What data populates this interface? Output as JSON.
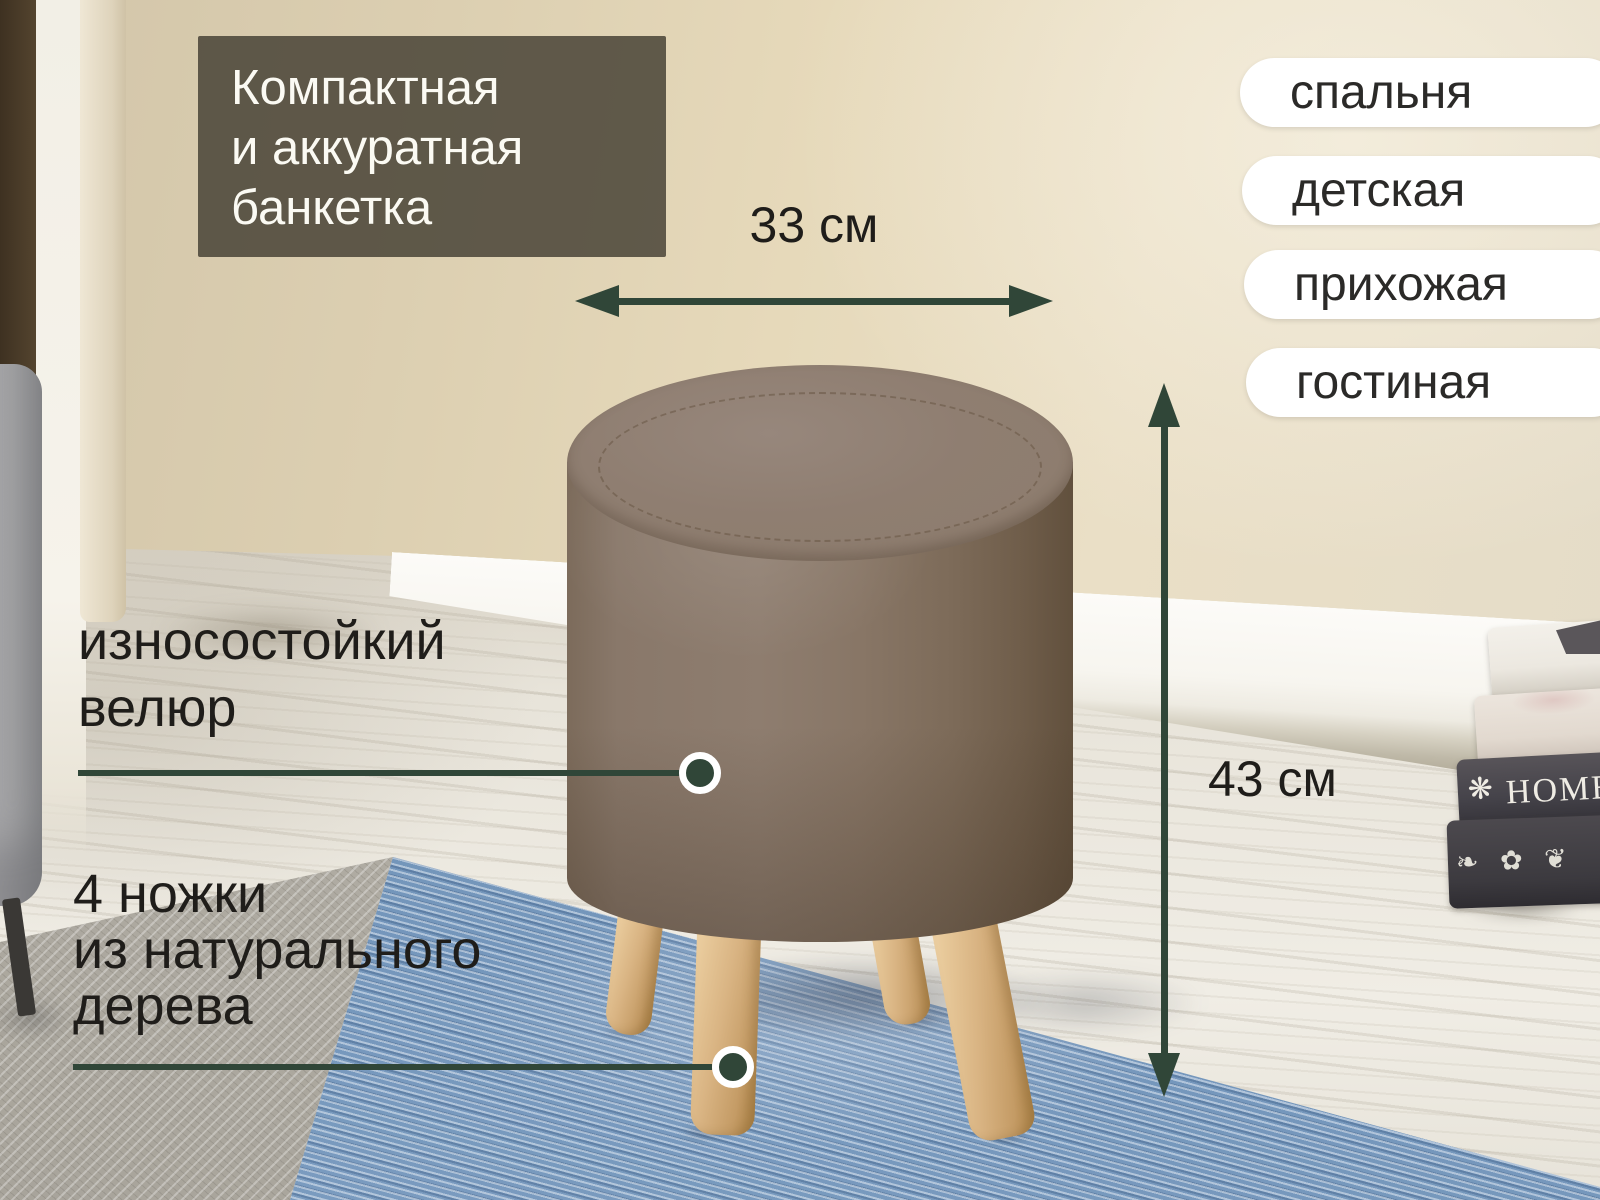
{
  "title": {
    "lines": [
      "Компактная",
      "и аккуратная",
      "банкетка"
    ]
  },
  "room_tags": [
    "спальня",
    "детская",
    "прихожая",
    "гостиная"
  ],
  "dimensions": {
    "width": "33 см",
    "height": "43 см"
  },
  "callouts": {
    "fabric": {
      "lines": [
        "износостойкий",
        "велюр"
      ]
    },
    "legs": {
      "lines": [
        "4 ножки",
        "из натурального",
        "дерева"
      ]
    }
  },
  "decor": {
    "book_spine": "HOME",
    "book_ornament": "❋",
    "book_scroll": "❧ ✿ ❦"
  },
  "colors": {
    "accent": "#304638",
    "ink": "#1f1d1a",
    "overlay_bg": "rgba(62,58,46,0.8)",
    "overlay_text": "#fbfaf3",
    "pill_bg": "#ffffff",
    "pill_text": "#2b2a28",
    "pouf_fabric": "#8e7d6f",
    "leg_wood": "#d9b483",
    "rug_blue": "#7e9fc4"
  }
}
